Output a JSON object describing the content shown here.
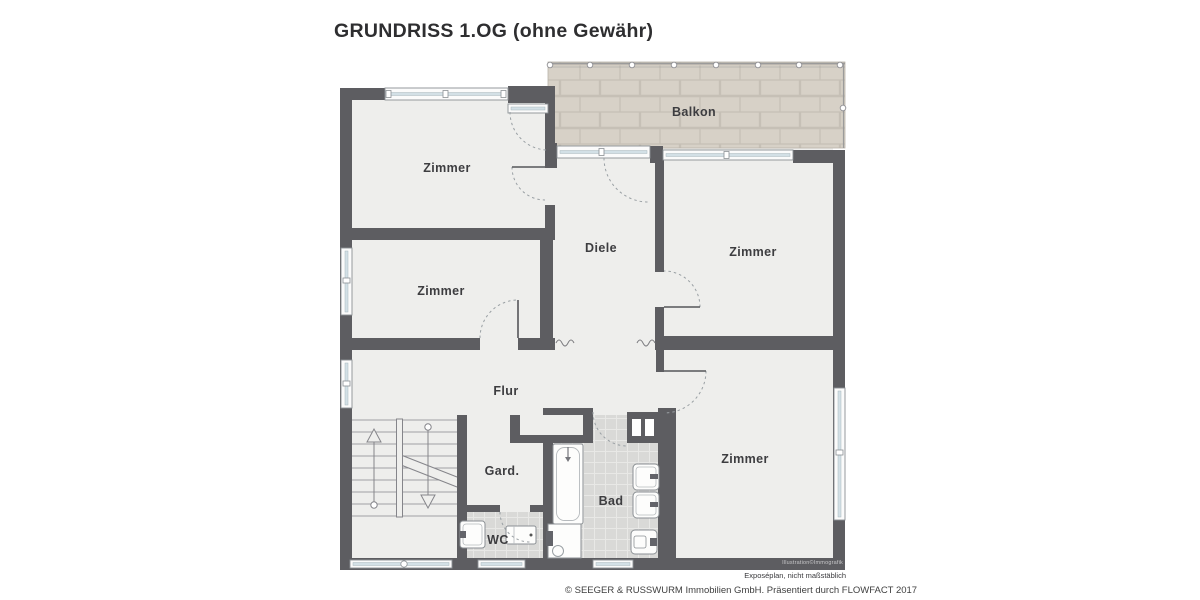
{
  "title": "GRUNDRISS 1.OG (ohne Gewähr)",
  "rooms": {
    "balkon": "Balkon",
    "zimmer_top_left": "Zimmer",
    "zimmer_mid_left": "Zimmer",
    "zimmer_top_right": "Zimmer",
    "zimmer_bottom_right": "Zimmer",
    "diele": "Diele",
    "flur": "Flur",
    "garderobe": "Gard.",
    "bad": "Bad",
    "wc": "WC"
  },
  "footer": {
    "watermark": "Illustration©Immografik",
    "disclaimer": "Exposéplan, nicht maßstäblich",
    "copyright": "© SEEGER & RUSSWURM Immobilien GmbH. Präsentiert durch FLOWFACT 2017"
  },
  "colors": {
    "wall": "#5d5d61",
    "floor": "#eeeeec",
    "balcony_brick": "#d7d1c7",
    "brick_mortar": "#c6c0b6",
    "tile": "#d9d9d7",
    "tile_grout": "#e8e8e6",
    "window_glass": "#d3e0e6",
    "label_text": "#3d3d40"
  }
}
